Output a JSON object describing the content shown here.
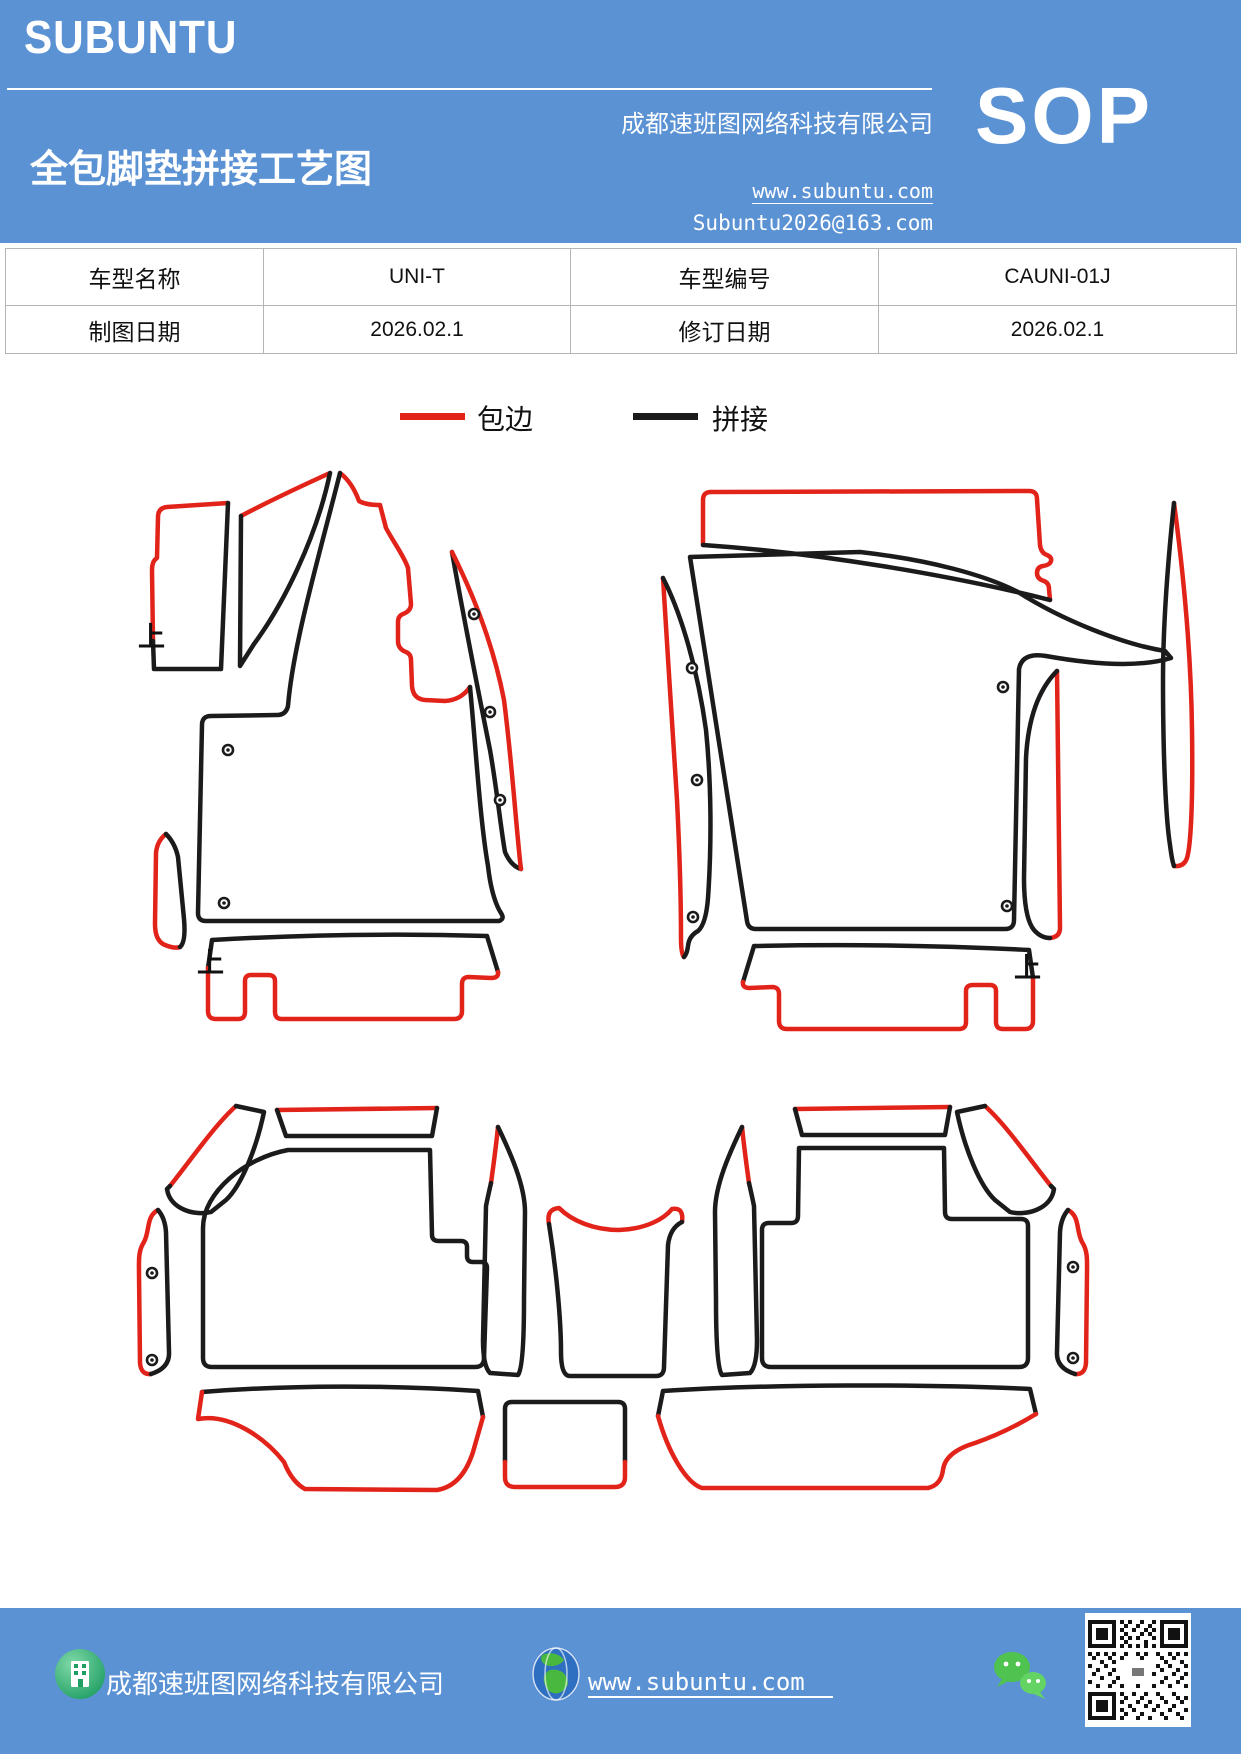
{
  "header": {
    "logo": "SUBUNTU",
    "title": "全包脚垫拼接工艺图",
    "company": "成都速班图网络科技有限公司",
    "website": "www.subuntu.com",
    "email": "Subuntu2026@163.com",
    "badge": "SOP"
  },
  "info_table": {
    "rows": [
      [
        {
          "label": "车型名称",
          "value": "UNI-T"
        },
        {
          "label": "车型编号",
          "value": "CAUNI-01J"
        }
      ],
      [
        {
          "label": "制图日期",
          "value": "2026.02.1"
        },
        {
          "label": "修订日期",
          "value": "2026.02.1"
        }
      ]
    ]
  },
  "legend": {
    "items": [
      {
        "label": "包边",
        "color": "#e2231a"
      },
      {
        "label": "拼接",
        "color": "#1b1b1b"
      }
    ]
  },
  "diagram": {
    "orientation_mark": "上"
  },
  "footer": {
    "company": "成都速班图网络科技有限公司",
    "website": "www.subuntu.com"
  },
  "colors": {
    "header_blue": "#5b92d4",
    "edge_red": "#e2231a",
    "splice_black": "#1b1b1b"
  }
}
